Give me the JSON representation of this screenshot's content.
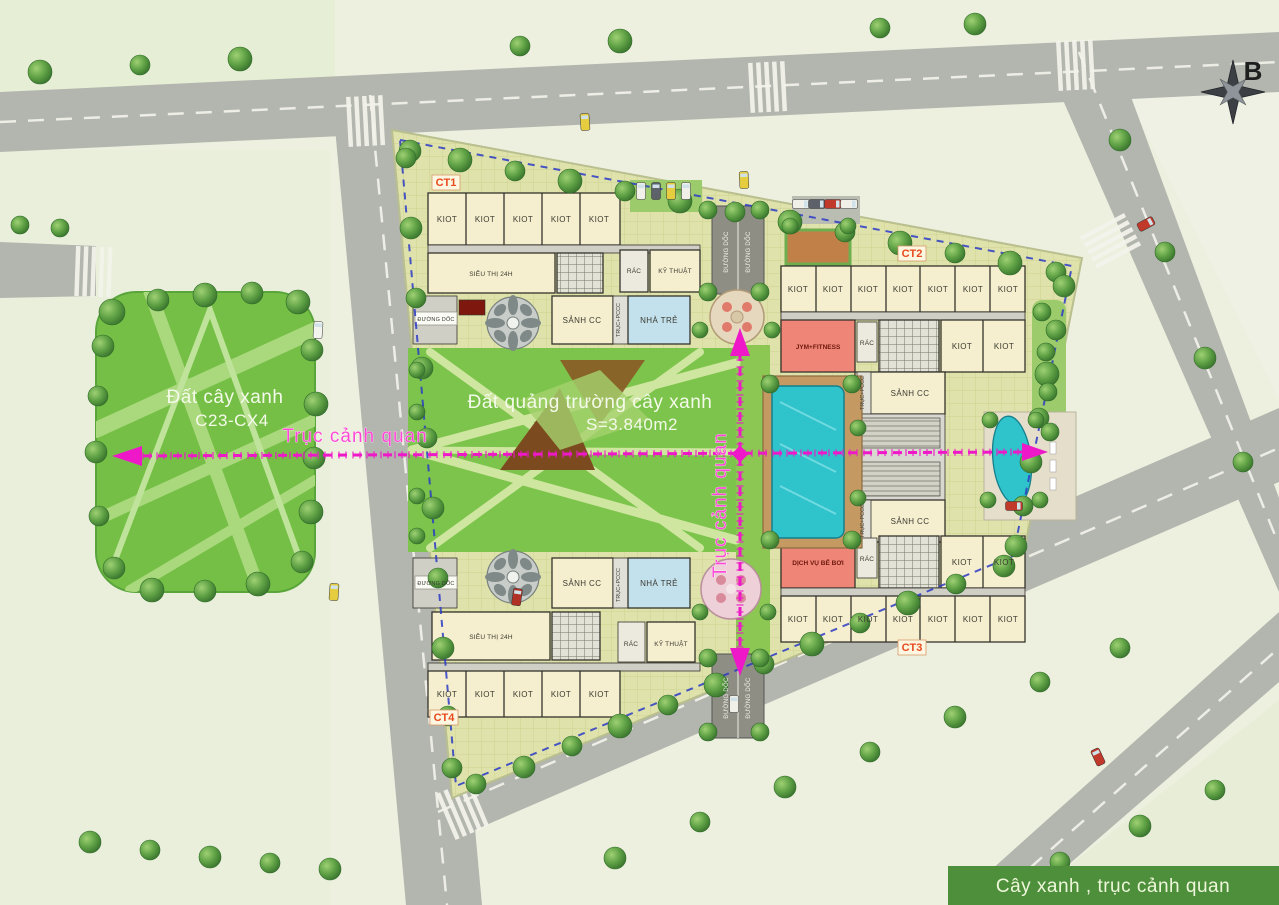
{
  "compass": {
    "north_label": "B"
  },
  "legend": {
    "label": "Cây xanh , trục cảnh quan"
  },
  "park": {
    "title": "Đất cây xanh",
    "code": "C23-CX4"
  },
  "plaza": {
    "title": "Đất quảng trường cây xanh",
    "area": "S=3.840m2"
  },
  "axes": {
    "horizontal_label": "Trục cảnh quan",
    "vertical_label": "Trục cảnh quan"
  },
  "buildings": {
    "ct1": "CT1",
    "ct2": "CT2",
    "ct3": "CT3",
    "ct4": "CT4"
  },
  "rooms": {
    "kiot": "KIOT",
    "supermarket": "SIÊU THỊ 24H",
    "lobby": "SẢNH CC",
    "kindergarten": "NHÀ TRẺ",
    "trash": "RÁC",
    "technical": "KỸ THUẬT",
    "gym": "JYM+FITNESS",
    "pool_service": "DỊCH VỤ BỂ BƠI",
    "ramp": "ĐƯỜNG DỐC",
    "core": "TRỤC+PCCC"
  },
  "colors": {
    "axis_magenta": "#ee18c8",
    "boundary_blue": "#2b3bc4",
    "legend_green": "#4e8f3c",
    "building_cream": "#f6efcf",
    "service_pink": "#ef8577",
    "pool_teal": "#2fc3cb",
    "ct_label_orange": "#e8491d",
    "park_green": "#76bf47"
  }
}
